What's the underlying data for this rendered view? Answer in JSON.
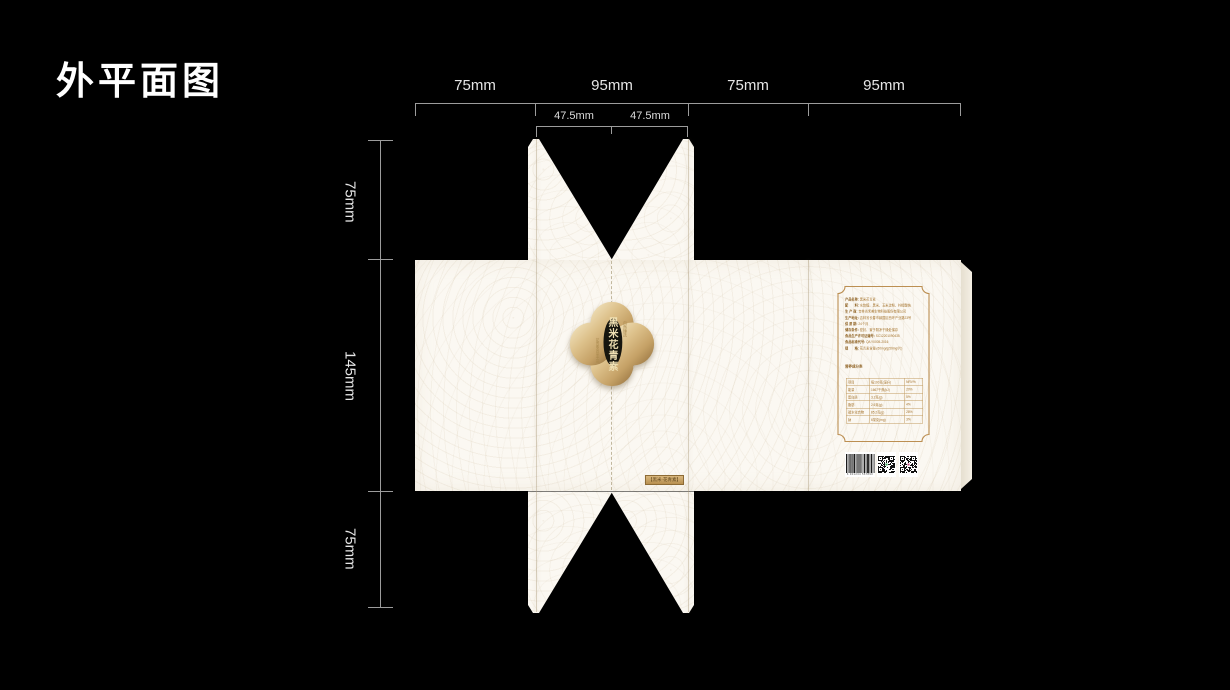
{
  "title": "外平面图",
  "rulers": {
    "top": [
      "75mm",
      "95mm",
      "75mm",
      "95mm"
    ],
    "top_sub": [
      "47.5mm",
      "47.5mm"
    ],
    "left": [
      "75mm",
      "145mm",
      "75mm"
    ]
  },
  "dieline": {
    "logo": {
      "name": "黑米花青素",
      "sub_right": "自然臻选",
      "sub_left": "花青素含量丰富"
    },
    "front_label": "【黑米·花青素】",
    "back_panel": {
      "info": [
        {
          "l": "产品名称:",
          "v": "黑米花青素"
        },
        {
          "l": "配　　料:",
          "v": "水饴糖、黑米、玉米淀粉、柠檬酸钠"
        },
        {
          "l": "生 产 商:",
          "v": "吉林省禾美生物科技股份有限公司"
        },
        {
          "l": "生产地址:",
          "v": "吉林省长春市绿园区西环产业路23号"
        },
        {
          "l": "保 质 期:",
          "v": "24个月"
        },
        {
          "l": "储存条件:",
          "v": "密封、置于阴凉干燥处保存"
        },
        {
          "l": "食品生产许可证编号:",
          "v": "SC12201090435"
        },
        {
          "l": "食品标准代号:",
          "v": "Q/LY0005-2016"
        },
        {
          "l": "规　　格:",
          "v": "花青素含量≥50mg/g(50mg/片)"
        }
      ],
      "nutrition": {
        "title": "营养成分表",
        "rows": [
          [
            "项目",
            "每100克(毫升)",
            "NRV%"
          ],
          [
            "能量",
            "1667千焦(kJ)",
            "20%"
          ],
          [
            "蛋白质",
            "3.2克(g)",
            "5%"
          ],
          [
            "脂肪",
            "2.6克(g)",
            "4%"
          ],
          [
            "碳水化合物",
            "85.2克(g)",
            "28%"
          ],
          [
            "钠",
            "6毫克(mg)",
            "3%"
          ]
        ]
      },
      "barcode_digits": "6 901234 567890"
    }
  },
  "colors": {
    "gold_frame": "#bc8f52",
    "text_brown": "#a5732c",
    "paper": "#fbf8f2",
    "medallion_gold": "#d2b176",
    "qr1_dot": "#3aa55a",
    "qr2_dot": "#c2477e"
  }
}
